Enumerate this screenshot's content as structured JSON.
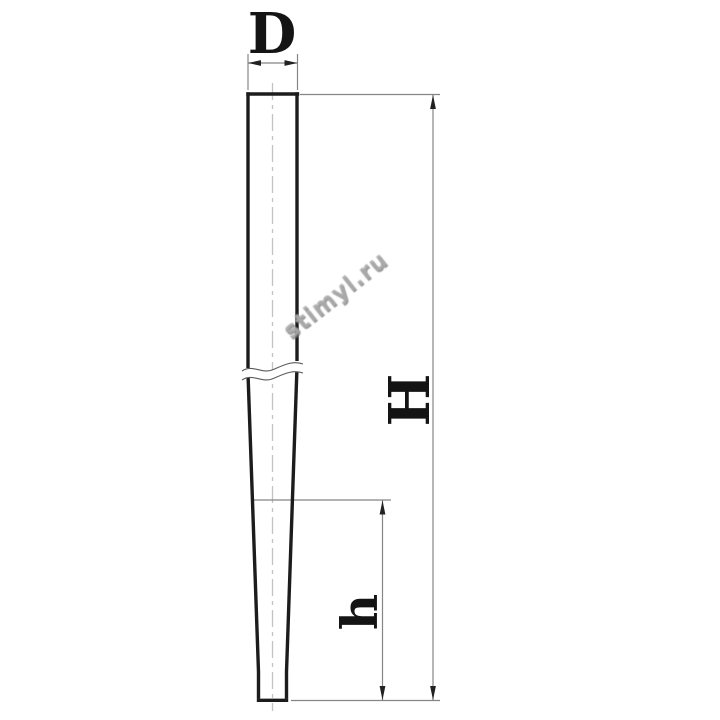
{
  "drawing": {
    "title": "tapered rod dimension diagram",
    "view": "front view with break line, dashed centerline, dimension callouts",
    "labels": {
      "diameter": "D",
      "total_height": "H",
      "partial_height": "h"
    },
    "colors": {
      "background": "#ffffff",
      "outline": "#1c1c1c",
      "dimension_line": "#858585",
      "centerline": "#c3c3c3",
      "label_text": "#141414",
      "watermark": "#9a9a9a"
    }
  },
  "watermark": {
    "text": "stimyl.ru"
  }
}
